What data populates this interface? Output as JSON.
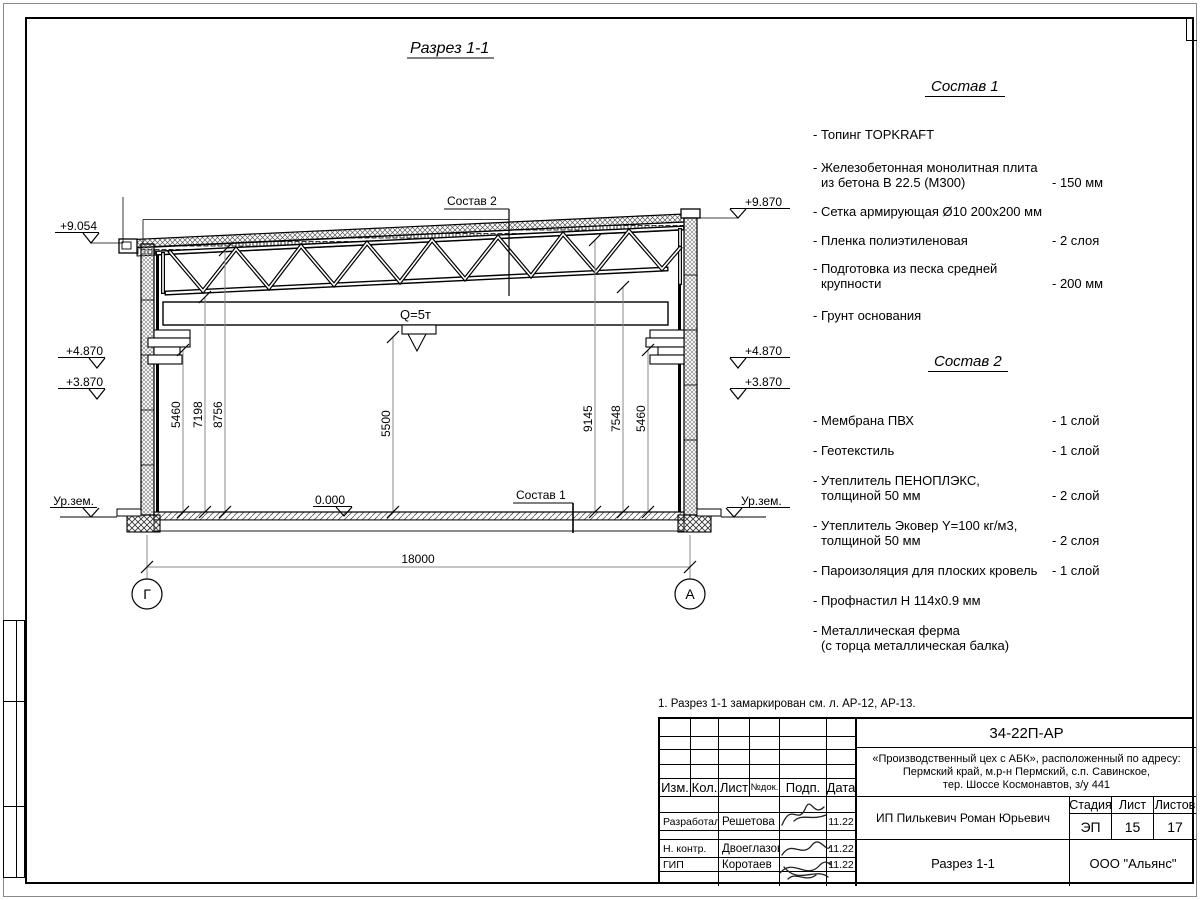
{
  "drawing": {
    "title": "Разрез 1-1",
    "callout_roof": "Состав 2",
    "callout_floor": "Состав 1",
    "crane_label": "Q=5т",
    "level_zero": "0.000",
    "ground_label_left": "Ур.зем.",
    "ground_label_right": "Ур.зем.",
    "levels_left": [
      "+9.054",
      "+4.870",
      "+3.870"
    ],
    "levels_right": [
      "+9.870",
      "+4.870",
      "+3.870"
    ],
    "dims_left": [
      "5460",
      "7198",
      "8756"
    ],
    "dim_mid": "5500",
    "dims_right": [
      "9145",
      "7548",
      "5460"
    ],
    "span_dim": "18000",
    "axis_left": "Г",
    "axis_right": "А"
  },
  "sostav1": {
    "heading": "Состав 1",
    "items": [
      {
        "l1": "- Топинг TOPKRAFT"
      },
      {
        "l1": "- Железобетонная  монолитная плита",
        "l2": "из бетона В 22.5 (М300)",
        "value": "- 150 мм"
      },
      {
        "l1": "- Сетка армирующая Ø10 200x200 мм"
      },
      {
        "l1": "- Пленка полиэтиленовая",
        "value": "-  2 слоя"
      },
      {
        "l1": "- Подготовка из песка средней",
        "l2": "крупности",
        "value": "- 200 мм"
      },
      {
        "l1": "- Грунт основания"
      }
    ]
  },
  "sostav2": {
    "heading": "Состав 2",
    "items": [
      {
        "l1": "- Мембрана ПВХ",
        "value": "- 1 слой"
      },
      {
        "l1": "- Геотекстиль",
        "value": "- 1 слой"
      },
      {
        "l1": "- Утеплитель ПЕНОПЛЭКС,",
        "l2": "толщиной 50 мм",
        "value": "- 2 слой"
      },
      {
        "l1": "- Утеплитель Эковер Y=100 кг/м3,",
        "l2": "толщиной 50 мм",
        "value": "- 2 слоя"
      },
      {
        "l1": "- Пароизоляция для плоских кровель",
        "value": "- 1 слой"
      },
      {
        "l1": "- Профнастил Н 114x0.9 мм"
      },
      {
        "l1": "- Металлическая ферма",
        "l2": "(с торца металлическая балка)"
      }
    ]
  },
  "titleblock": {
    "note": "1. Разрез 1-1 замаркирован см. л. АР-12, АР-13.",
    "doc_number": "34-22П-АР",
    "project_line1": "«Производственный цех с АБК», расположенный по адресу:",
    "project_line2": "Пермский край, м.р-н Пермский, с.п. Савинское,",
    "project_line3": "тер. Шоссе Космонавтов, з/у 441",
    "client": "ИП Пилькевич Роман Юрьевич",
    "sheet_title": "Разрез 1-1",
    "org": "ООО \"Альянс\"",
    "stage_label": "Стадия",
    "stage": "ЭП",
    "sheet_label": "Лист",
    "sheet": "15",
    "sheets_label": "Листов",
    "sheets": "17",
    "col_izm": "Изм.",
    "col_kol": "Кол.",
    "col_list": "Лист",
    "col_ndok": "№док.",
    "col_podp": "Подп.",
    "col_data": "Дата",
    "rows": [
      {
        "role": "Разработал",
        "name": "Решетова",
        "date": "11.22"
      },
      {
        "role": "Н. контр.",
        "name": "Двоеглазов",
        "date": "11.22"
      },
      {
        "role": "ГИП",
        "name": "Коротаев",
        "date": "11.22"
      }
    ]
  }
}
